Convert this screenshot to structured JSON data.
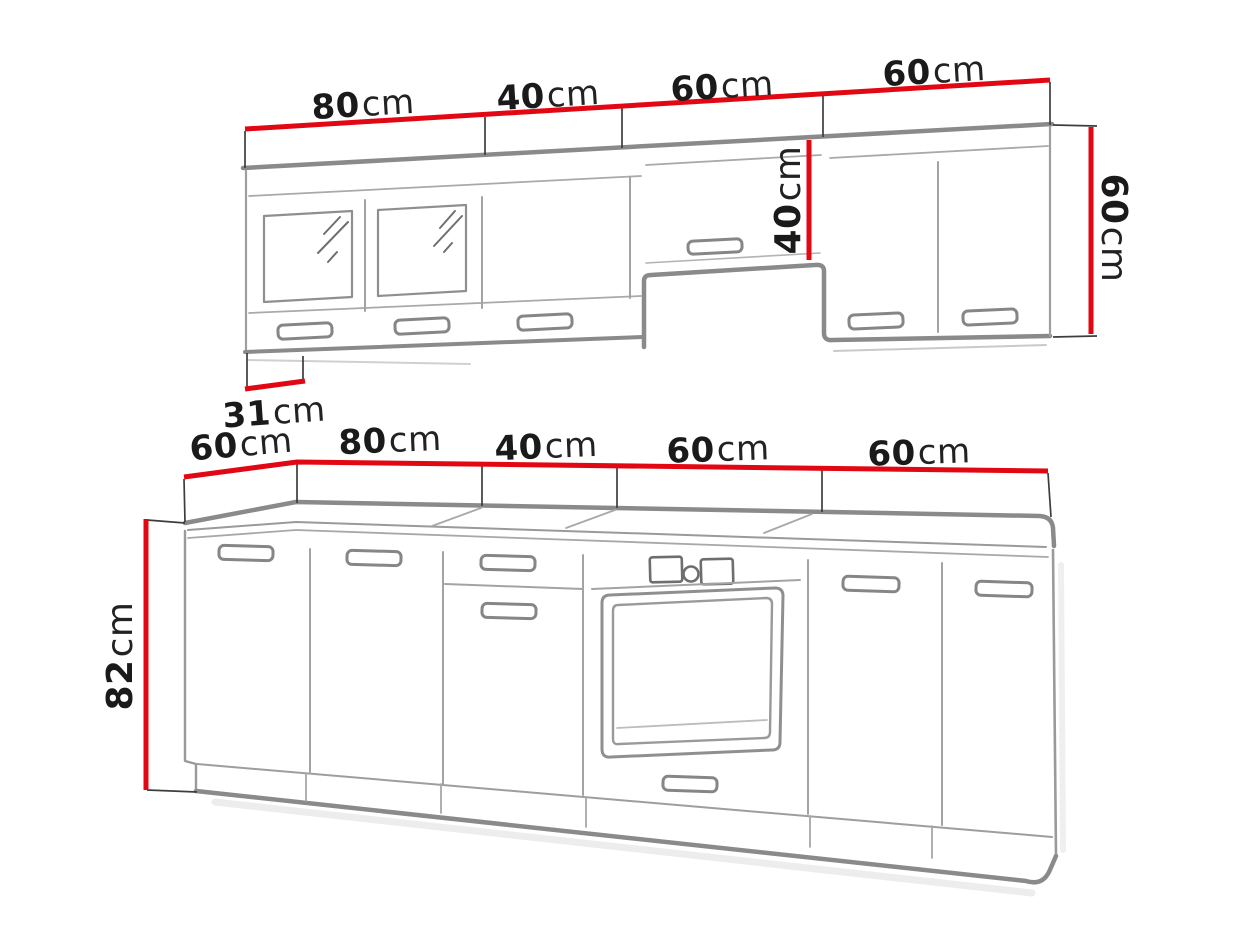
{
  "diagram": {
    "kind": "kitchen-set-dimension-drawing",
    "colors": {
      "dimension_line": "#e10813",
      "cabinet_outline": "#8a8a8a",
      "thin_line": "#9e9e9e",
      "extension_line": "#3d3d3d",
      "label_text": "#1a1a1a",
      "background": "#ffffff"
    },
    "wall_units": {
      "widths": [
        {
          "num": "80",
          "unit": "cm"
        },
        {
          "num": "40",
          "unit": "cm"
        },
        {
          "num": "60",
          "unit": "cm"
        },
        {
          "num": "60",
          "unit": "cm"
        }
      ],
      "hood_unit_height": {
        "num": "40",
        "unit": "cm"
      },
      "side_height": {
        "num": "60",
        "unit": "cm"
      },
      "bottom_depth": {
        "num": "31",
        "unit": "cm"
      }
    },
    "base_units": {
      "widths": [
        {
          "num": "60",
          "unit": "cm"
        },
        {
          "num": "80",
          "unit": "cm"
        },
        {
          "num": "40",
          "unit": "cm"
        },
        {
          "num": "60",
          "unit": "cm"
        },
        {
          "num": "60",
          "unit": "cm"
        }
      ],
      "side_height": {
        "num": "82",
        "unit": "cm"
      }
    }
  }
}
